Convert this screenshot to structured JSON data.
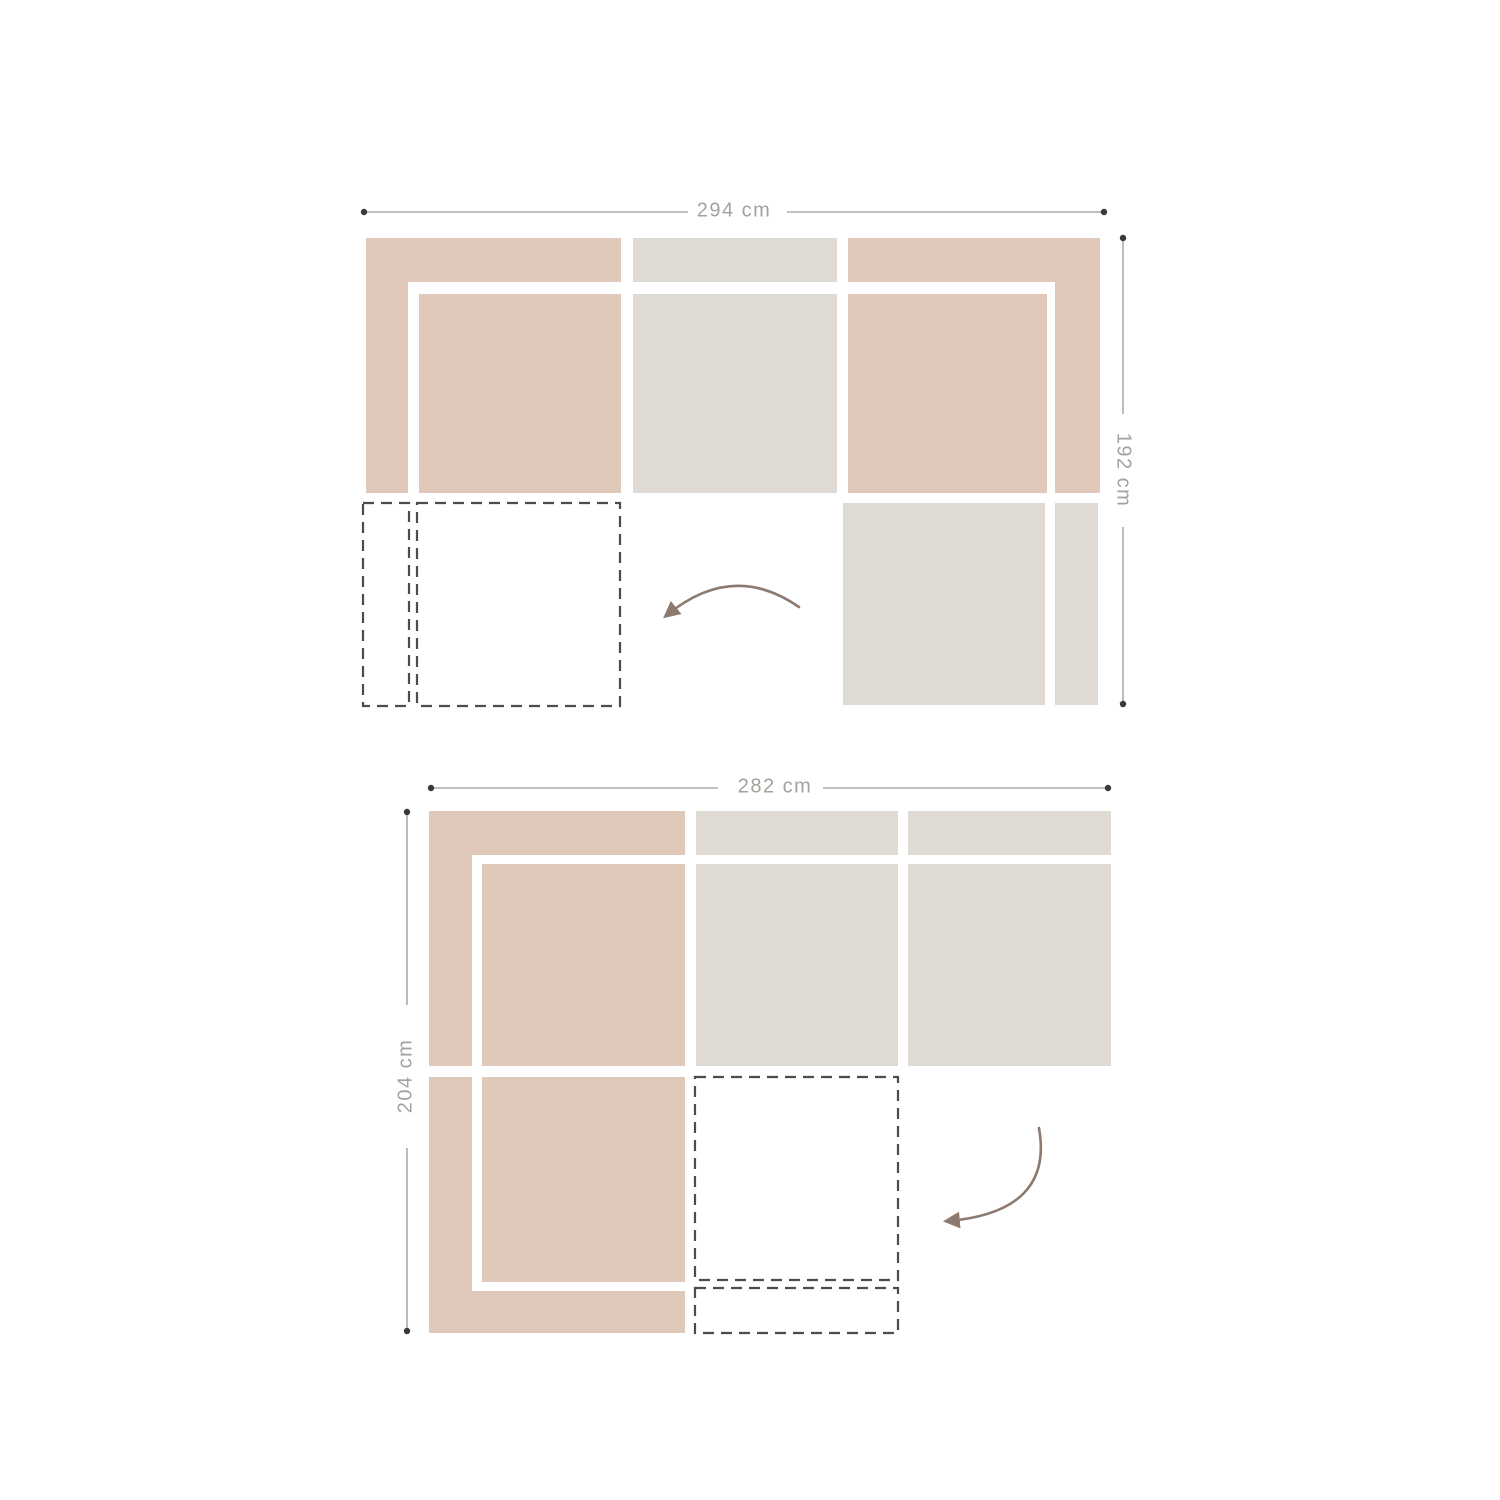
{
  "colors": {
    "background": "#ffffff",
    "fabric_tan": "#e0c9ba",
    "fabric_gray": "#e0dad5",
    "dash_outline": "#4c4c4c",
    "arrow": "#8c7a6f",
    "dim_line": "#9c9894",
    "dim_dot": "#3c3a38",
    "label_text": "#a5a19d"
  },
  "diagrams": {
    "top": {
      "width_label": "294 cm",
      "height_label": "192 cm"
    },
    "bottom": {
      "width_label": "282 cm",
      "height_label": "204 cm"
    }
  },
  "icons": {
    "top_arrow": "curved-swap-arrow-left",
    "bottom_arrow": "curved-swap-arrow-down-left"
  }
}
